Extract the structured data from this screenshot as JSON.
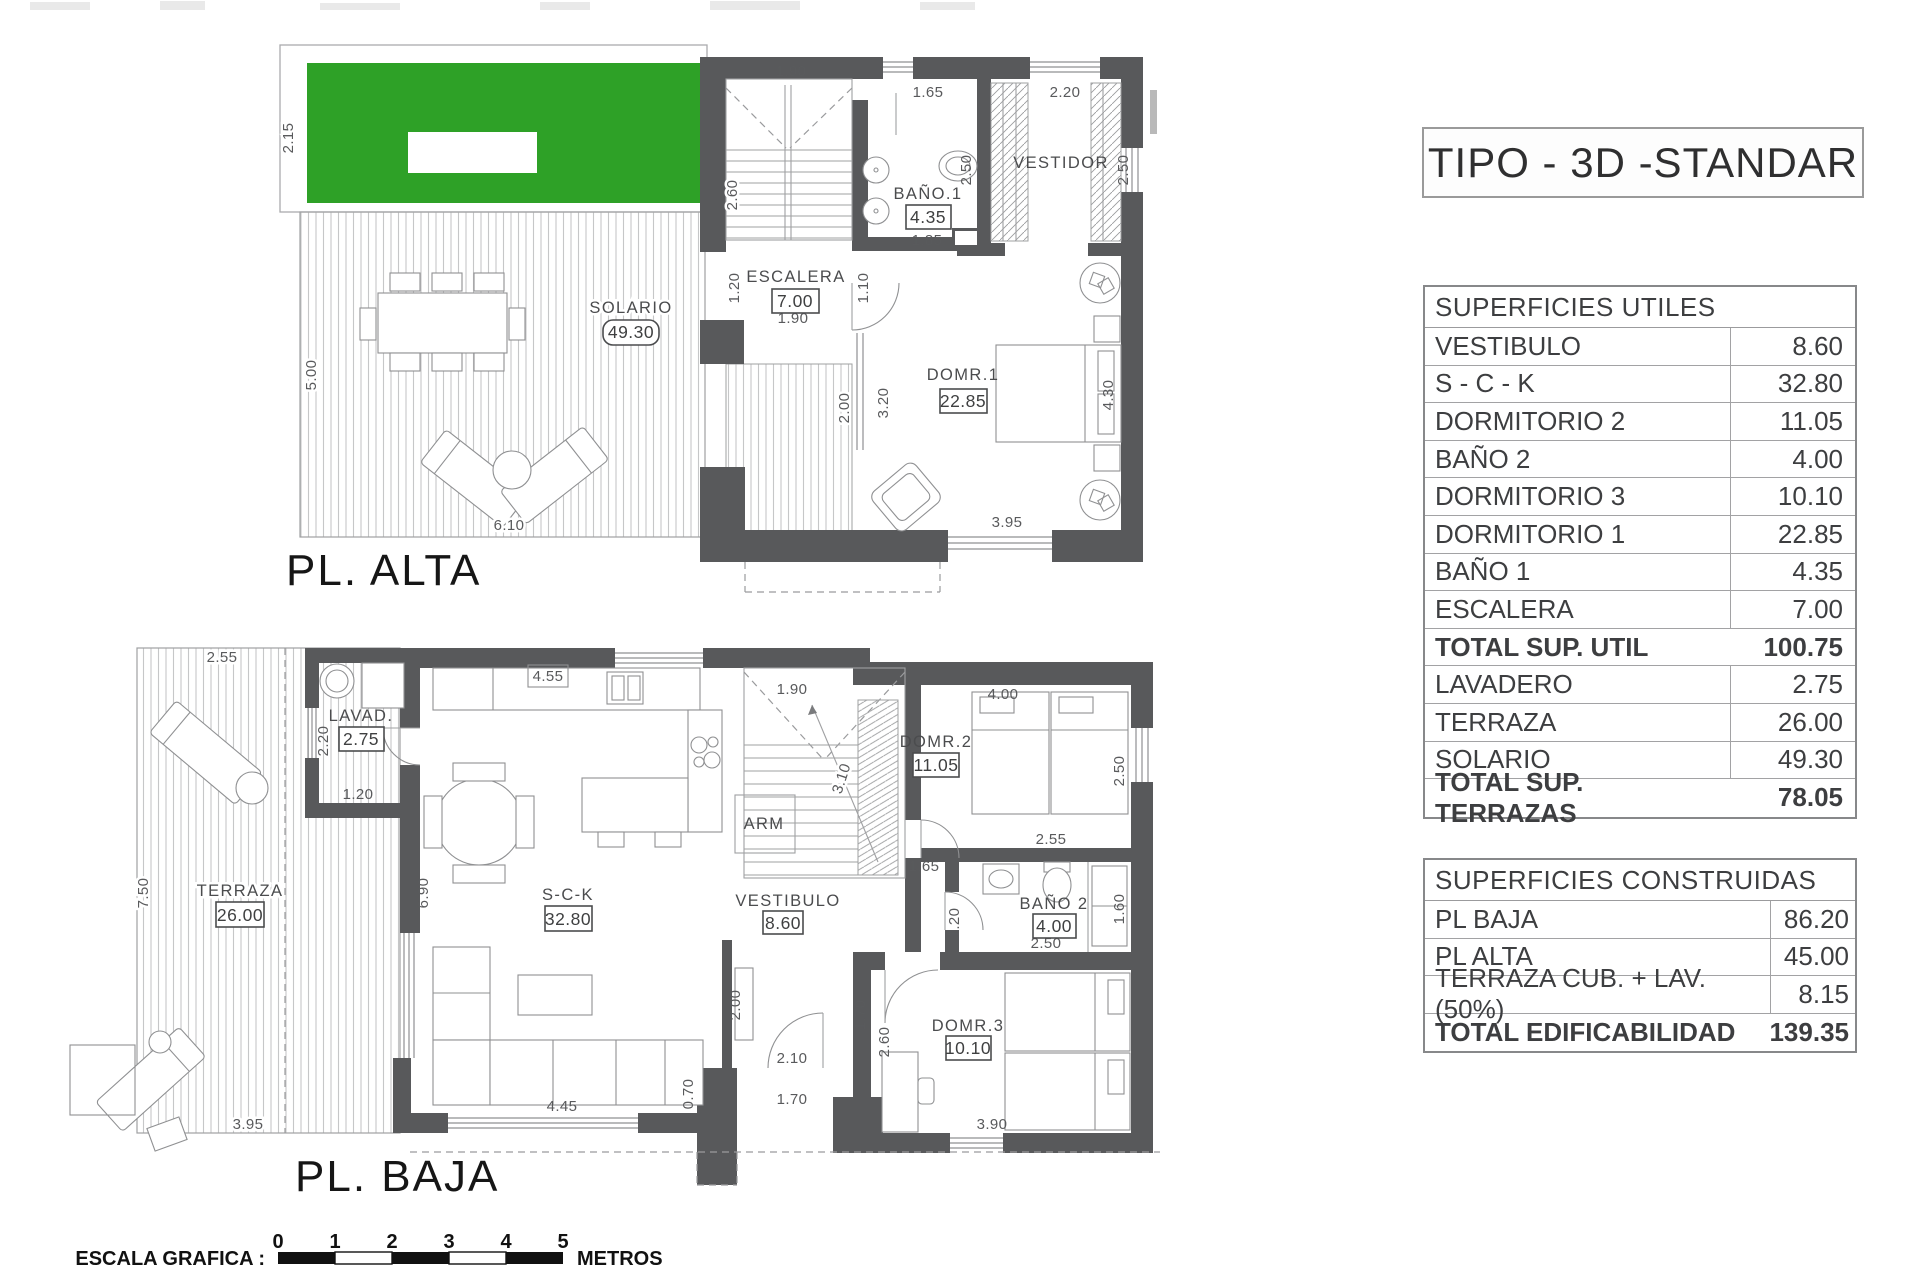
{
  "title": "TIPO - 3D -STANDAR",
  "colors": {
    "green": "#2ea127",
    "wall": "#58595b"
  },
  "tables": {
    "utiles": {
      "header": "SUPERFICIES UTILES",
      "rows": [
        {
          "label": "VESTIBULO",
          "value": "8.60"
        },
        {
          "label": "S - C - K",
          "value": "32.80"
        },
        {
          "label": "DORMITORIO 2",
          "value": "11.05"
        },
        {
          "label": "BAÑO 2",
          "value": "4.00"
        },
        {
          "label": "DORMITORIO 3",
          "value": "10.10"
        },
        {
          "label": "DORMITORIO 1",
          "value": "22.85"
        },
        {
          "label": "BAÑO 1",
          "value": "4.35"
        },
        {
          "label": "ESCALERA",
          "value": "7.00"
        },
        {
          "label": "TOTAL SUP. UTIL",
          "value": "100.75"
        },
        {
          "label": "LAVADERO",
          "value": "2.75"
        },
        {
          "label": "TERRAZA",
          "value": "26.00"
        },
        {
          "label": "SOLARIO",
          "value": "49.30"
        },
        {
          "label": "TOTAL SUP. TERRAZAS",
          "value": "78.05"
        }
      ]
    },
    "construidas": {
      "header": "SUPERFICIES CONSTRUIDAS",
      "rows": [
        {
          "label": "PL BAJA",
          "value": "86.20"
        },
        {
          "label": "PL ALTA",
          "value": "45.00"
        },
        {
          "label": "TERRAZA CUB. + LAV. (50%)",
          "value": "8.15"
        },
        {
          "label": "TOTAL EDIFICABILIDAD",
          "value": "139.35"
        }
      ]
    }
  },
  "plans": {
    "alta": {
      "title": "PL. ALTA",
      "rooms": {
        "solario": {
          "label": "SOLARIO",
          "area": "49.30"
        },
        "escalera": {
          "label": "ESCALERA",
          "area": "7.00"
        },
        "bano1": {
          "label": "BAÑO.1",
          "area": "4.35"
        },
        "vestidor": {
          "label": "VESTIDOR"
        },
        "domr1": {
          "label": "DOMR.1",
          "area": "22.85"
        }
      },
      "dims": [
        "2.15",
        "5.00",
        "6.10",
        "1.90",
        "2.60",
        "1.20",
        "1.90",
        "1.10",
        "1.65",
        "2.50",
        "1.85",
        "2.20",
        "2.50",
        "2.00",
        "3.20",
        "4.30",
        "3.95"
      ]
    },
    "baja": {
      "title": "PL. BAJA",
      "rooms": {
        "lavadero": {
          "label": "LAVAD.",
          "area": "2.75"
        },
        "terraza": {
          "label": "TERRAZA",
          "area": "26.00"
        },
        "sck": {
          "label": "S-C-K",
          "area": "32.80"
        },
        "vestibulo": {
          "label": "VESTIBULO",
          "area": "8.60"
        },
        "arm": {
          "label": "ARM"
        },
        "domr2": {
          "label": "DOMR.2",
          "area": "11.05"
        },
        "bano2": {
          "label": "BAÑO 2",
          "area": "4.00"
        },
        "domr3": {
          "label": "DOMR.3",
          "area": "10.10"
        }
      },
      "dims": [
        "2.55",
        "2.20",
        "1.20",
        "7.50",
        "4.55",
        "1.90",
        "6.90",
        "3.10",
        "4.00",
        "2.50",
        "2.55",
        "1.65",
        "1.20",
        "1.60",
        "2.50",
        "2.60",
        "1.70",
        "3.90",
        "4.45",
        "0.70",
        "2.00",
        "2.10",
        "1.70",
        "3.95"
      ]
    }
  },
  "scale_bar": {
    "label": "ESCALA GRAFICA :",
    "ticks": [
      "0",
      "1",
      "2",
      "3",
      "4",
      "5"
    ],
    "units": "METROS"
  }
}
